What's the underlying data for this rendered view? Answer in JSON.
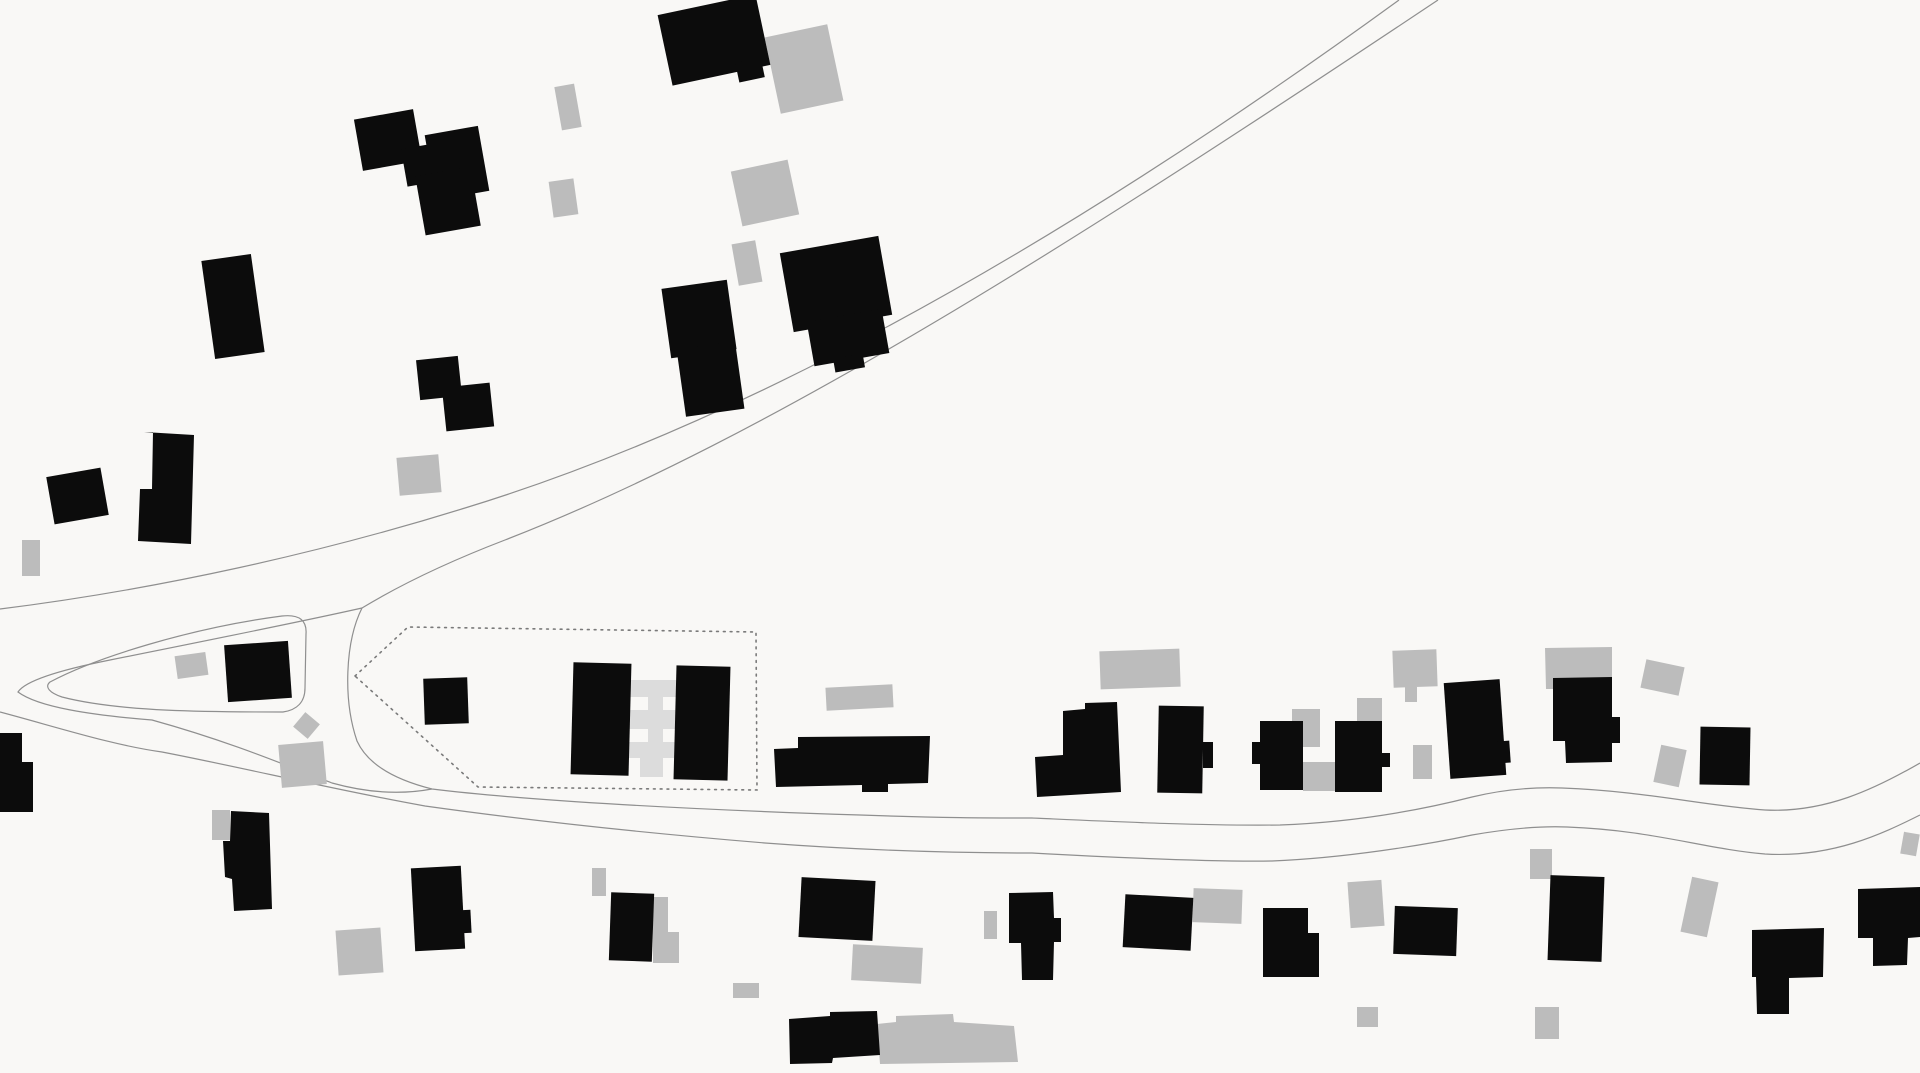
{
  "map": {
    "kind": "figure-ground-site-plan",
    "canvas": {
      "width": 1920,
      "height": 1073,
      "background": "#f9f8f6"
    },
    "colors": {
      "building_primary": "#0c0c0c",
      "building_secondary": "#bcbcbc",
      "building_link": "#dcdcdc",
      "road_line": "#8f8f8f",
      "boundary_dot": "#7a7a7a"
    },
    "roads": [
      {
        "name": "main-road-north-edge",
        "d": "M0,609 C160,589 320,553 465,508 C760,418 1080,232 1399,0"
      },
      {
        "name": "main-road-south-edge",
        "d": "M1438,0 C1075,242 770,437 505,540 C445,563 400,585 362,608 C345,642 343,700 357,741 C367,763 392,779 432,789 C530,801 700,810 860,815 C940,818 990,818 1032,818 C1100,821 1200,826 1280,825 C1360,822 1425,809 1472,797 C1505,789 1535,787 1562,788 C1645,791 1705,806 1765,810 C1825,813 1875,789 1920,763"
      },
      {
        "name": "lower-road-south-edge",
        "d": "M0,712 C60,728 112,745 162,752 C245,768 335,790 425,806 C525,820 645,833 765,843 C885,852 985,853 1032,853 C1105,857 1205,862 1272,861 C1345,858 1425,845 1472,835 C1512,828 1542,826 1567,827 C1652,830 1705,849 1765,854 C1832,858 1882,834 1920,815"
      },
      {
        "name": "west-fork-edge",
        "d": "M362,608 C300,622 200,642 110,660 C60,670 25,681 18,692 C38,707 90,715 152,720 C235,743 292,768 332,783 C368,793 400,795 432,789"
      },
      {
        "name": "island-parcel-outline",
        "d": "M50,682 C95,658 190,628 282,616 C300,614 307,621 306,634 L305,688 C305,702 297,710 283,712 C210,712 120,712 62,697 C50,693 44,687 50,682 Z"
      }
    ],
    "site_boundary": {
      "name": "dotted-site-boundary",
      "points": "355,676 408,627 756,632 757,790 478,787"
    },
    "link_bars": [
      {
        "x": 627,
        "y": 680,
        "w": 50,
        "h": 17,
        "r": 0
      },
      {
        "x": 627,
        "y": 710,
        "w": 51,
        "h": 19,
        "r": 0
      },
      {
        "x": 627,
        "y": 742,
        "w": 50,
        "h": 16,
        "r": 0
      },
      {
        "x": 648,
        "y": 680,
        "w": 15,
        "h": 97,
        "r": 0
      },
      {
        "x": 640,
        "y": 758,
        "w": 23,
        "h": 19,
        "r": 0
      }
    ],
    "gray_rects": [
      {
        "x": 772,
        "y": 30,
        "w": 64,
        "h": 78,
        "r": -12
      },
      {
        "x": 558,
        "y": 85,
        "w": 20,
        "h": 44,
        "r": -10
      },
      {
        "x": 551,
        "y": 180,
        "w": 25,
        "h": 36,
        "r": -8
      },
      {
        "x": 736,
        "y": 165,
        "w": 58,
        "h": 56,
        "r": -12
      },
      {
        "x": 735,
        "y": 242,
        "w": 24,
        "h": 42,
        "r": -10
      },
      {
        "x": 22,
        "y": 540,
        "w": 18,
        "h": 36,
        "r": 0
      },
      {
        "x": 398,
        "y": 456,
        "w": 42,
        "h": 38,
        "r": -5
      },
      {
        "x": 176,
        "y": 654,
        "w": 31,
        "h": 23,
        "r": -8
      },
      {
        "x": 297,
        "y": 716,
        "w": 19,
        "h": 19,
        "r": 40
      },
      {
        "x": 280,
        "y": 743,
        "w": 45,
        "h": 43,
        "r": -5
      },
      {
        "x": 826,
        "y": 686,
        "w": 67,
        "h": 23,
        "r": -3
      },
      {
        "x": 1100,
        "y": 650,
        "w": 80,
        "h": 38,
        "r": -2
      },
      {
        "x": 1292,
        "y": 709,
        "w": 28,
        "h": 38,
        "r": 0
      },
      {
        "x": 1303,
        "y": 762,
        "w": 32,
        "h": 29,
        "r": 0
      },
      {
        "x": 1357,
        "y": 698,
        "w": 25,
        "h": 23,
        "r": 0
      },
      {
        "x": 1393,
        "y": 650,
        "w": 44,
        "h": 37,
        "r": -2
      },
      {
        "x": 1405,
        "y": 687,
        "w": 12,
        "h": 15,
        "r": 0
      },
      {
        "x": 1413,
        "y": 745,
        "w": 19,
        "h": 34,
        "r": 0
      },
      {
        "x": 1643,
        "y": 663,
        "w": 39,
        "h": 29,
        "r": 12
      },
      {
        "x": 1657,
        "y": 747,
        "w": 26,
        "h": 38,
        "r": 12
      },
      {
        "x": 212,
        "y": 810,
        "w": 18,
        "h": 30,
        "r": 0
      },
      {
        "x": 337,
        "y": 929,
        "w": 45,
        "h": 45,
        "r": -4
      },
      {
        "x": 592,
        "y": 868,
        "w": 14,
        "h": 28,
        "r": 0
      },
      {
        "x": 733,
        "y": 983,
        "w": 26,
        "h": 15,
        "r": 0
      },
      {
        "x": 852,
        "y": 946,
        "w": 70,
        "h": 36,
        "r": 3
      },
      {
        "x": 984,
        "y": 911,
        "w": 13,
        "h": 28,
        "r": 0
      },
      {
        "x": 1193,
        "y": 889,
        "w": 49,
        "h": 34,
        "r": 2
      },
      {
        "x": 1349,
        "y": 881,
        "w": 34,
        "h": 46,
        "r": -4
      },
      {
        "x": 1357,
        "y": 1007,
        "w": 21,
        "h": 20,
        "r": 0
      },
      {
        "x": 1530,
        "y": 849,
        "w": 22,
        "h": 30,
        "r": 0
      },
      {
        "x": 1535,
        "y": 1007,
        "w": 24,
        "h": 32,
        "r": 0
      },
      {
        "x": 1686,
        "y": 879,
        "w": 27,
        "h": 56,
        "r": 12
      },
      {
        "x": 1902,
        "y": 833,
        "w": 16,
        "h": 22,
        "r": 10
      }
    ],
    "gray_polys": [
      {
        "points": "1545,648 1612,647 1612,678 1570,679 1570,689 1546,689"
      },
      {
        "points": "653,897 668,897 668,932 679,932 679,963 653,963"
      },
      {
        "points": "877,1024 896,1022 896,1016 953,1014 954,1022 1014,1026 1018,1062 880,1064"
      }
    ],
    "black_rects": [
      {
        "x": 664,
        "y": 4,
        "w": 100,
        "h": 72,
        "r": -12
      },
      {
        "x": 737,
        "y": 60,
        "w": 26,
        "h": 20,
        "r": -12
      },
      {
        "x": 358,
        "y": 114,
        "w": 60,
        "h": 52,
        "r": -10
      },
      {
        "x": 404,
        "y": 146,
        "w": 34,
        "h": 38,
        "r": -10
      },
      {
        "x": 430,
        "y": 130,
        "w": 54,
        "h": 66,
        "r": -10
      },
      {
        "x": 420,
        "y": 171,
        "w": 56,
        "h": 60,
        "r": -10
      },
      {
        "x": 666,
        "y": 284,
        "w": 66,
        "h": 70,
        "r": -8
      },
      {
        "x": 681,
        "y": 345,
        "w": 59,
        "h": 68,
        "r": -8
      },
      {
        "x": 786,
        "y": 244,
        "w": 100,
        "h": 80,
        "r": -10
      },
      {
        "x": 810,
        "y": 315,
        "w": 76,
        "h": 45,
        "r": -10
      },
      {
        "x": 834,
        "y": 356,
        "w": 30,
        "h": 14,
        "r": -10
      },
      {
        "x": 208,
        "y": 257,
        "w": 50,
        "h": 99,
        "r": -8
      },
      {
        "x": 418,
        "y": 358,
        "w": 42,
        "h": 40,
        "r": -6
      },
      {
        "x": 444,
        "y": 385,
        "w": 48,
        "h": 44,
        "r": -6
      },
      {
        "x": 50,
        "y": 472,
        "w": 55,
        "h": 48,
        "r": -10
      },
      {
        "x": 226,
        "y": 643,
        "w": 64,
        "h": 57,
        "r": -4
      },
      {
        "x": 424,
        "y": 678,
        "w": 44,
        "h": 46,
        "r": -2
      },
      {
        "x": 572,
        "y": 663,
        "w": 58,
        "h": 112,
        "r": 1.5
      },
      {
        "x": 675,
        "y": 666,
        "w": 54,
        "h": 114,
        "r": 1.5
      },
      {
        "x": 1158,
        "y": 706,
        "w": 45,
        "h": 87,
        "r": 1
      },
      {
        "x": 1203,
        "y": 742,
        "w": 10,
        "h": 26,
        "r": 0
      },
      {
        "x": 1260,
        "y": 721,
        "w": 43,
        "h": 69,
        "r": 0
      },
      {
        "x": 1252,
        "y": 742,
        "w": 8,
        "h": 22,
        "r": 0
      },
      {
        "x": 1335,
        "y": 721,
        "w": 47,
        "h": 71,
        "r": 0
      },
      {
        "x": 1382,
        "y": 753,
        "w": 8,
        "h": 14,
        "r": 0
      },
      {
        "x": 1447,
        "y": 681,
        "w": 56,
        "h": 96,
        "r": -4
      },
      {
        "x": 1498,
        "y": 741,
        "w": 12,
        "h": 22,
        "r": -4
      },
      {
        "x": 1700,
        "y": 727,
        "w": 50,
        "h": 58,
        "r": 1
      },
      {
        "x": 413,
        "y": 867,
        "w": 50,
        "h": 83,
        "r": -3
      },
      {
        "x": 461,
        "y": 910,
        "w": 10,
        "h": 23,
        "r": -3
      },
      {
        "x": 610,
        "y": 893,
        "w": 43,
        "h": 68,
        "r": 2
      },
      {
        "x": 800,
        "y": 879,
        "w": 74,
        "h": 60,
        "r": 3
      },
      {
        "x": 1124,
        "y": 896,
        "w": 68,
        "h": 53,
        "r": 3
      },
      {
        "x": 1394,
        "y": 907,
        "w": 63,
        "h": 48,
        "r": 2
      },
      {
        "x": 1549,
        "y": 876,
        "w": 54,
        "h": 85,
        "r": 2
      }
    ],
    "black_polys": [
      {
        "points": "144,432 194,435 191,544 138,541 140,489 152,489 153,432"
      },
      {
        "points": "0,733 22,733 22,762 33,762 33,812 0,812"
      },
      {
        "points": "774,749 798,748 798,737 930,736 928,783 888,784 888,792 862,792 862,785 776,787"
      },
      {
        "points": "1063,711 1085,709 1085,703 1117,702 1121,792 1037,797 1035,757 1063,755"
      },
      {
        "points": "1553,678 1612,677 1612,717 1620,717 1620,743 1612,743 1612,762 1566,763 1565,741 1553,741"
      },
      {
        "points": "231,811 269,813 272,909 234,911 232,879 225,877 223,841 230,841"
      },
      {
        "points": "789,1019 830,1016 830,1012 877,1011 880,1055 833,1058 832,1063 790,1064"
      },
      {
        "points": "1009,893 1053,892 1054,918 1061,918 1061,942 1054,942 1053,980 1022,980 1021,943 1009,943"
      },
      {
        "points": "1263,908 1308,908 1308,933 1319,933 1319,977 1263,977"
      },
      {
        "points": "1752,930 1824,928 1823,977 1789,978 1789,1014 1757,1014 1756,977 1752,977"
      },
      {
        "points": "1858,889 1920,887 1920,937 1908,938 1907,965 1873,966 1873,938 1858,938"
      }
    ]
  }
}
